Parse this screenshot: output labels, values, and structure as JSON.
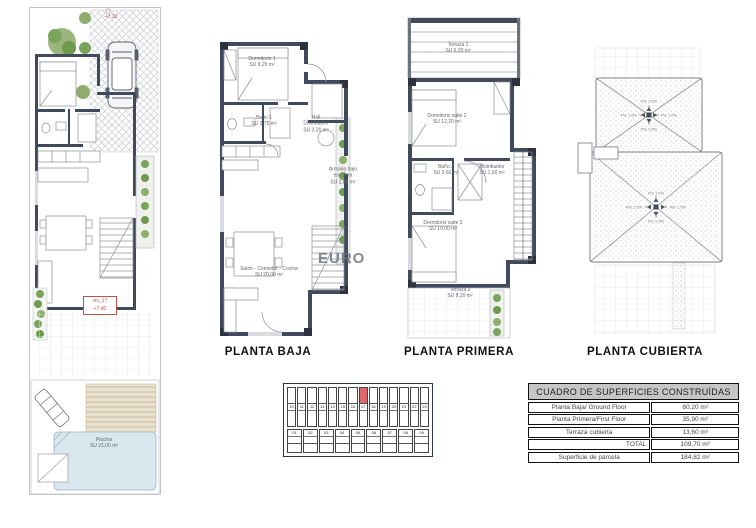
{
  "watermark": "EURO",
  "site_plan": {
    "level_top": "+7.10",
    "plot_id": "viv_17",
    "plot_level": "+7.40",
    "pool_name": "Piscina",
    "pool_area": "SU 21,00 m²"
  },
  "planta_baja": {
    "title": "PLANTA BAJA",
    "dorm1_name": "Dormitorio 1",
    "dorm1_area": "SU 9,20 m²",
    "bano1_name": "Baño 1",
    "bano1_area": "SU 3,75 m²",
    "hall_name": "Hall Distribuidor",
    "hall_area": "SU 3,20 m²",
    "armario_name": "Armario bajo escalera",
    "armario_area": "SU 1,85 m²",
    "salon_name": "Salón - Comedor - Cocina",
    "salon_area": "SU 20,00 m²"
  },
  "planta_primera": {
    "title": "PLANTA PRIMERA",
    "terraza1_name": "Terraza 1",
    "terraza1_area": "SU 6,20 m²",
    "suite2_name": "Dormitorio suite 2",
    "suite2_area": "SU 12,20 m²",
    "bano2_name": "Baño 2",
    "bano2_area": "SU 3,60 m²",
    "distribuidor_name": "Distribuidor",
    "distribuidor_area": "SU 1,60 m²",
    "suite3_name": "Dormitorio suite 3",
    "suite3_area": "SU 10,00 m²",
    "terraza2_name": "Terraza 2",
    "terraza2_area": "SU 8,20 m²"
  },
  "planta_cubierta": {
    "title": "PLANTA CUBIERTA",
    "slope": "Pte 1,5%"
  },
  "key_plan": {
    "top_row": [
      "10",
      "11",
      "12",
      "13",
      "14",
      "15",
      "16",
      "17",
      "18",
      "19",
      "20",
      "21",
      "22",
      "23"
    ],
    "bottom_row": [
      "01",
      "02",
      "03",
      "04",
      "05",
      "06",
      "07",
      "08",
      "09"
    ],
    "highlighted": "17"
  },
  "table": {
    "title": "CUADRO DE SUPERFICIES CONSTRUÍDAS",
    "rows": [
      {
        "label": "Planta Baja/ Ground Floor",
        "value": "60,20 m²"
      },
      {
        "label": "Planta Primera/First Floor",
        "value": "35,90 m²"
      },
      {
        "label": "Terraza cubierta",
        "value": "13,60 m²"
      },
      {
        "label": "TOTAL",
        "value": "109,70 m²"
      },
      {
        "label": "Superficie de parcela",
        "value": "184,82 m²"
      }
    ]
  }
}
